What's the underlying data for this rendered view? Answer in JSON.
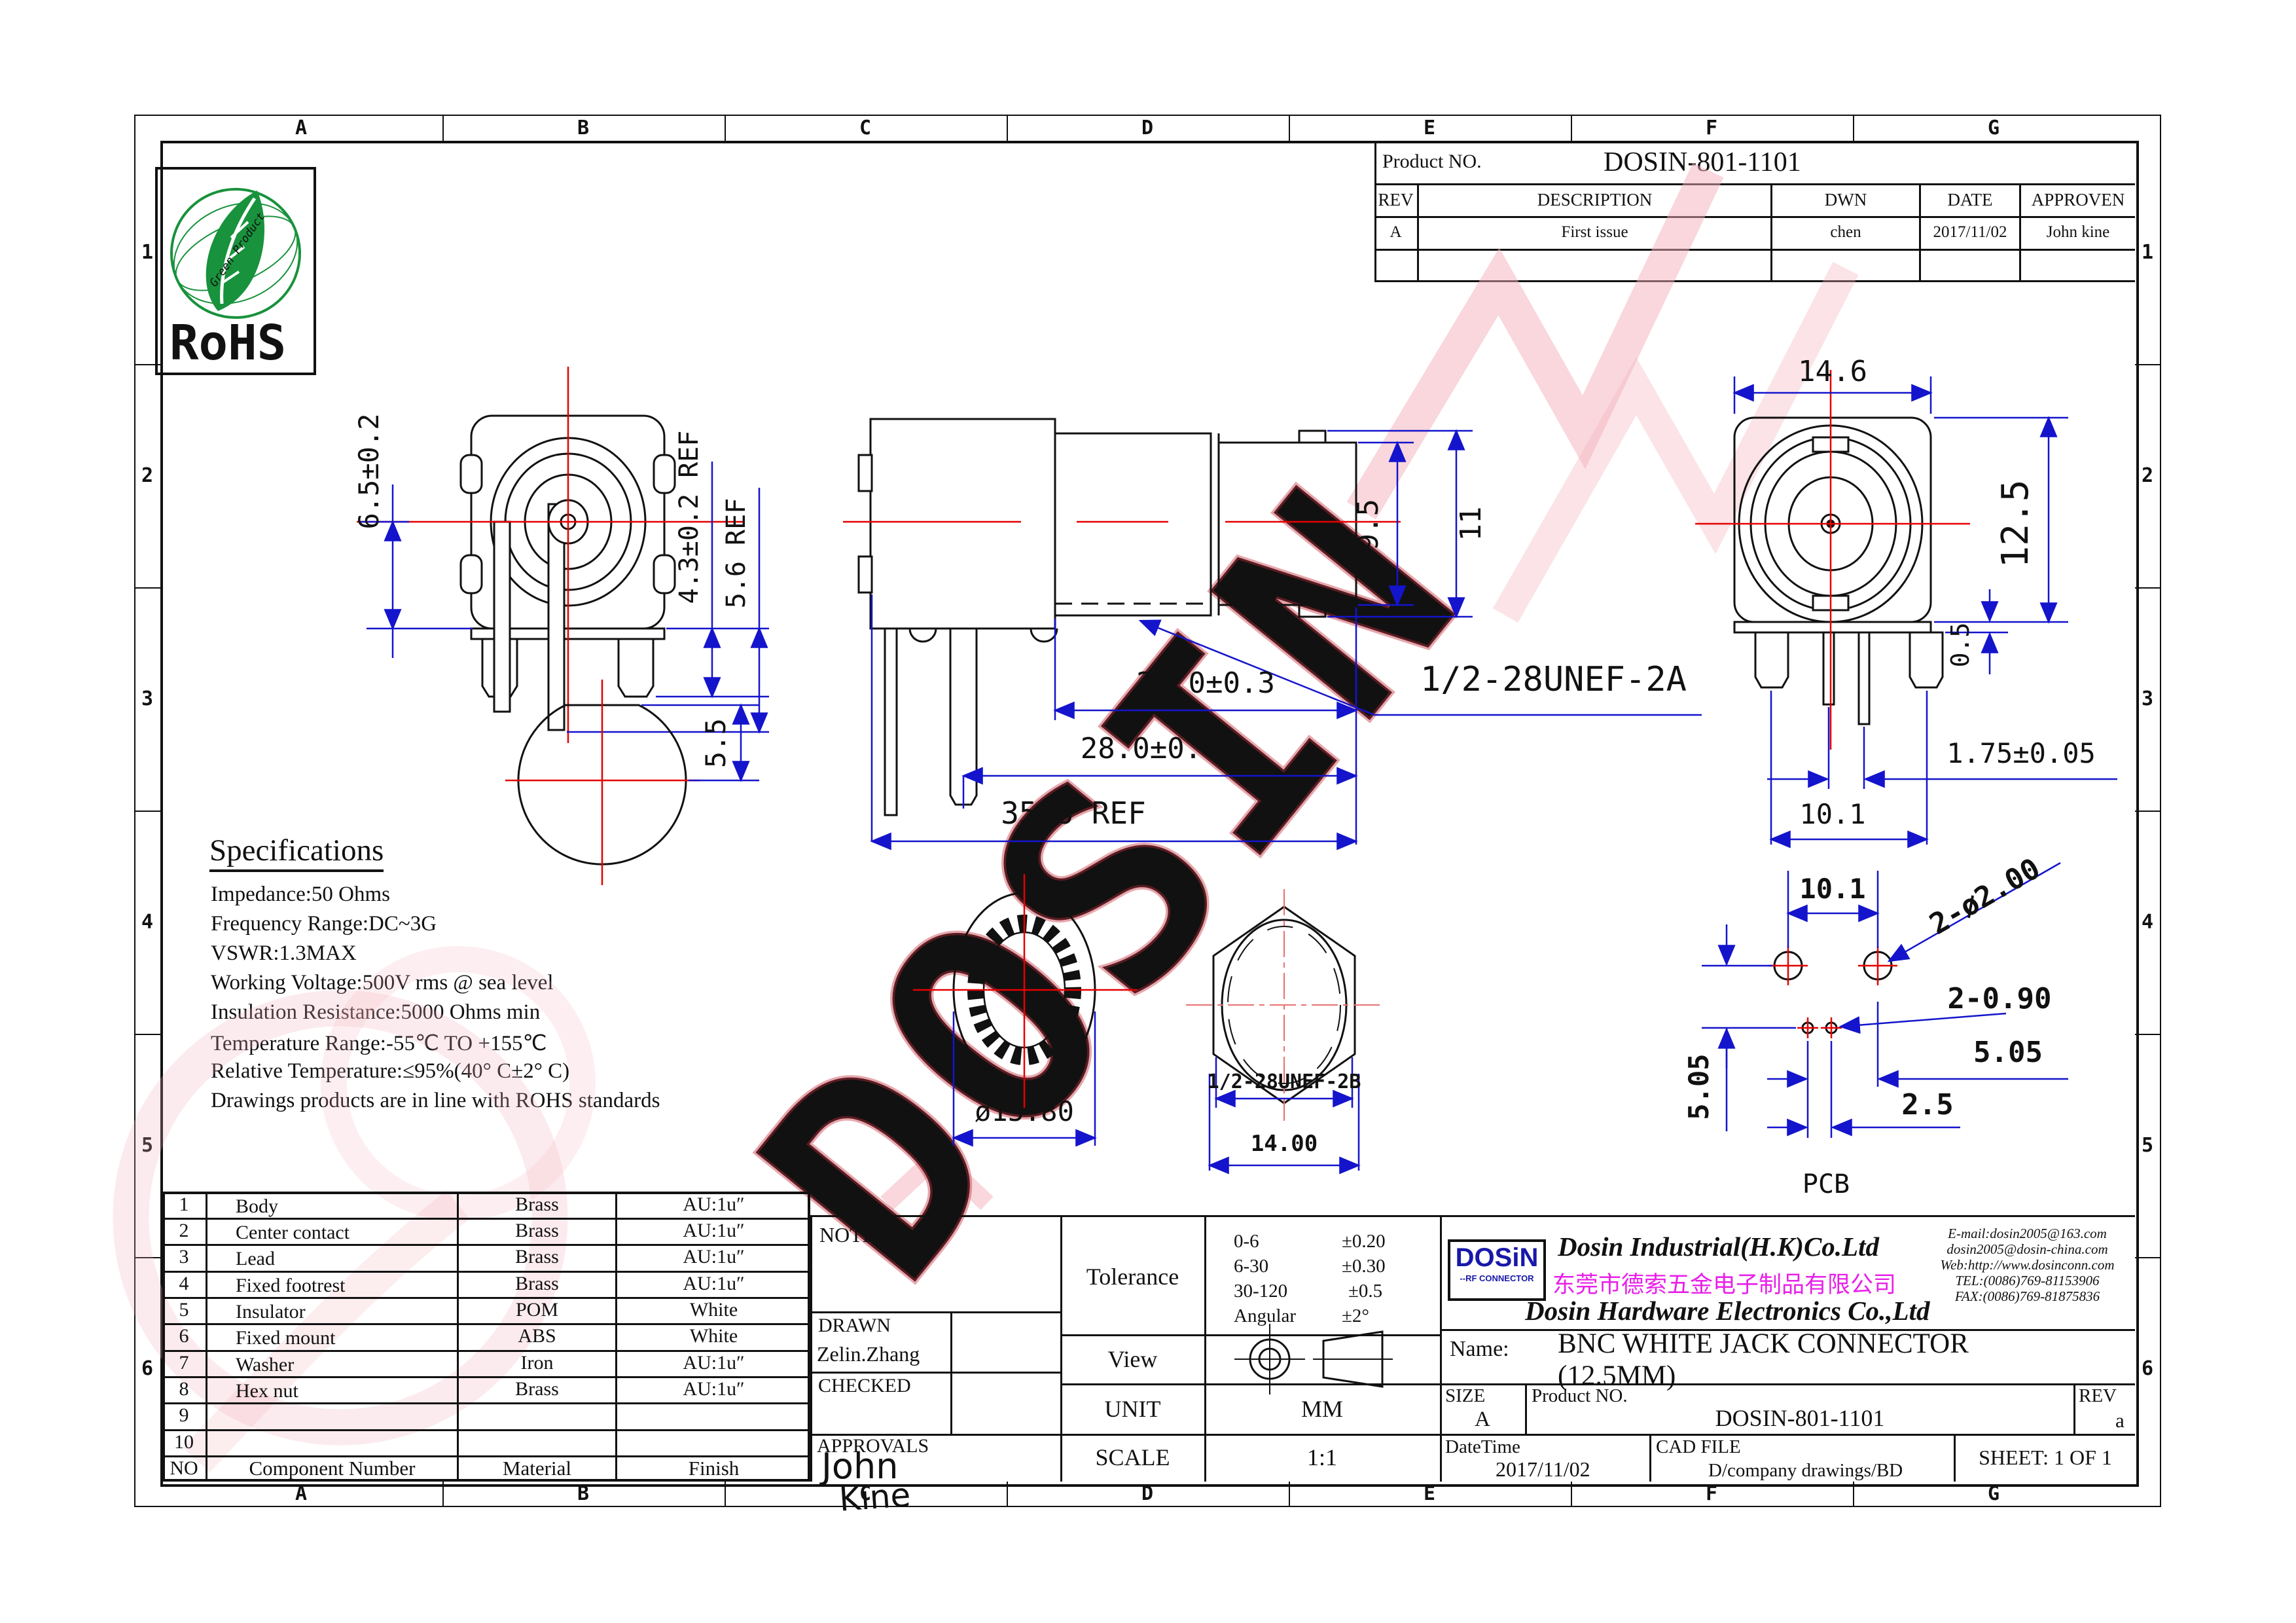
{
  "colors": {
    "line": "#111111",
    "dim_blue": "#1414cc",
    "center_red": "#e60000",
    "magenta": "#e820e8",
    "rohs_green": "#18923c",
    "logo_blue": "#1818aa",
    "logo_red": "#dd1111"
  },
  "border": {
    "columns": [
      "A",
      "B",
      "C",
      "D",
      "E",
      "F",
      "G"
    ],
    "rows": [
      "1",
      "2",
      "3",
      "4",
      "5",
      "6"
    ]
  },
  "title_block": {
    "product_no_label": "Product NO.",
    "product_no": "DOSIN-801-1101",
    "rev_header": [
      "REV",
      "DESCRIPTION",
      "DWN",
      "DATE",
      "APPROVEN"
    ],
    "rev_row": [
      "A",
      "First issue",
      "chen",
      "2017/11/02",
      "John kine"
    ]
  },
  "rohs": {
    "title": "RoHS",
    "curved": "Green Product"
  },
  "specifications": {
    "title": "Specifications",
    "lines": [
      "Impedance:50 Ohms",
      "Frequency Range:DC~3G",
      "VSWR:1.3MAX",
      "Working Voltage:500V rms @ sea level",
      "Insulation Resistance:5000 Ohms min",
      "Temperature Range:-55℃ TO +155℃",
      "Relative Temperature:≤95%(40° C±2° C)",
      "Drawings products are in line with ROHS standards"
    ]
  },
  "dims": {
    "front": [
      "6.5±0.2",
      "4.3±0.2 REF",
      "5.6 REF"
    ],
    "bottom_circle": [
      "5.5"
    ],
    "side": [
      "ø9.5",
      "11",
      "21.0±0.3",
      "28.0±0.40",
      "35.6 REF",
      "1/2-28UNEF-2A"
    ],
    "back": [
      "14.6",
      "12.5",
      "0.5",
      "1.75±0.05",
      "10.1"
    ],
    "washer": [
      "ø15.80"
    ],
    "hex_nut": [
      "1/2-28UNEF-2B",
      "14.00"
    ],
    "pcb": [
      "10.1",
      "2-ø2.00",
      "2-0.90",
      "5.05",
      "5.05",
      "2.5",
      "PCB"
    ]
  },
  "bom": {
    "rows": [
      [
        "1",
        "Body",
        "Brass",
        "AU:1u″"
      ],
      [
        "2",
        "Center contact",
        "Brass",
        "AU:1u″"
      ],
      [
        "3",
        "Lead",
        "Brass",
        "AU:1u″"
      ],
      [
        "4",
        "Fixed footrest",
        "Brass",
        "AU:1u″"
      ],
      [
        "5",
        "Insulator",
        "POM",
        "White"
      ],
      [
        "6",
        "Fixed mount",
        "ABS",
        "White"
      ],
      [
        "7",
        "Washer",
        "Iron",
        "AU:1u″"
      ],
      [
        "8",
        "Hex nut",
        "Brass",
        "AU:1u″"
      ],
      [
        "9",
        "",
        "",
        ""
      ],
      [
        "10",
        "",
        "",
        ""
      ]
    ],
    "footer": [
      "NO",
      "Component Number",
      "Material",
      "Finish"
    ]
  },
  "note_block": {
    "note": "NOTE:",
    "drawn_label": "DRAWN",
    "drawn": "Zelin.Zhang",
    "checked_label": "CHECKED",
    "approvals_label": "APPROVALS",
    "sig_line1": "John",
    "sig_line2": "Kine"
  },
  "tolerance": {
    "label": "Tolerance",
    "rows": [
      [
        "0-6",
        "±0.20"
      ],
      [
        "6-30",
        "±0.30"
      ],
      [
        "30-120",
        "±0.5"
      ],
      [
        "Angular",
        "±2°"
      ]
    ]
  },
  "view_row": {
    "label": "View"
  },
  "unit_row": {
    "label": "UNIT",
    "value": "MM"
  },
  "scale_row": {
    "label": "SCALE",
    "value": "1:1"
  },
  "company": {
    "logo_main": "DOSiN",
    "logo_sub": "--RF CONNECTOR",
    "name_en1": "Dosin Industrial(H.K)Co.Ltd",
    "name_cn": "东莞市德索五金电子制品有限公司",
    "name_en2": "Dosin Hardware Electronics Co.,Ltd",
    "contact": [
      "E-mail:dosin2005@163.com",
      "dosin2005@dosin-china.com",
      "Web:http://www.dosinconn.com",
      "TEL:(0086)769-81153906",
      "FAX:(0086)769-81875836"
    ]
  },
  "name_row": {
    "label": "Name:",
    "value": "BNC WHITE JACK CONNECTOR (12.5MM)"
  },
  "size_row": {
    "size_label": "SIZE",
    "size_value": "A",
    "product_label": "Product NO.",
    "product_value": "DOSIN-801-1101",
    "rev_label": "REV",
    "rev_value": "a"
  },
  "footer_row": {
    "datetime_label": "DateTime",
    "datetime_value": "2017/11/02",
    "cad_label": "CAD FILE",
    "cad_value": "D/company drawings/BD",
    "sheet": "SHEET: 1 OF 1"
  },
  "watermark": {
    "text": "DOSIN"
  }
}
